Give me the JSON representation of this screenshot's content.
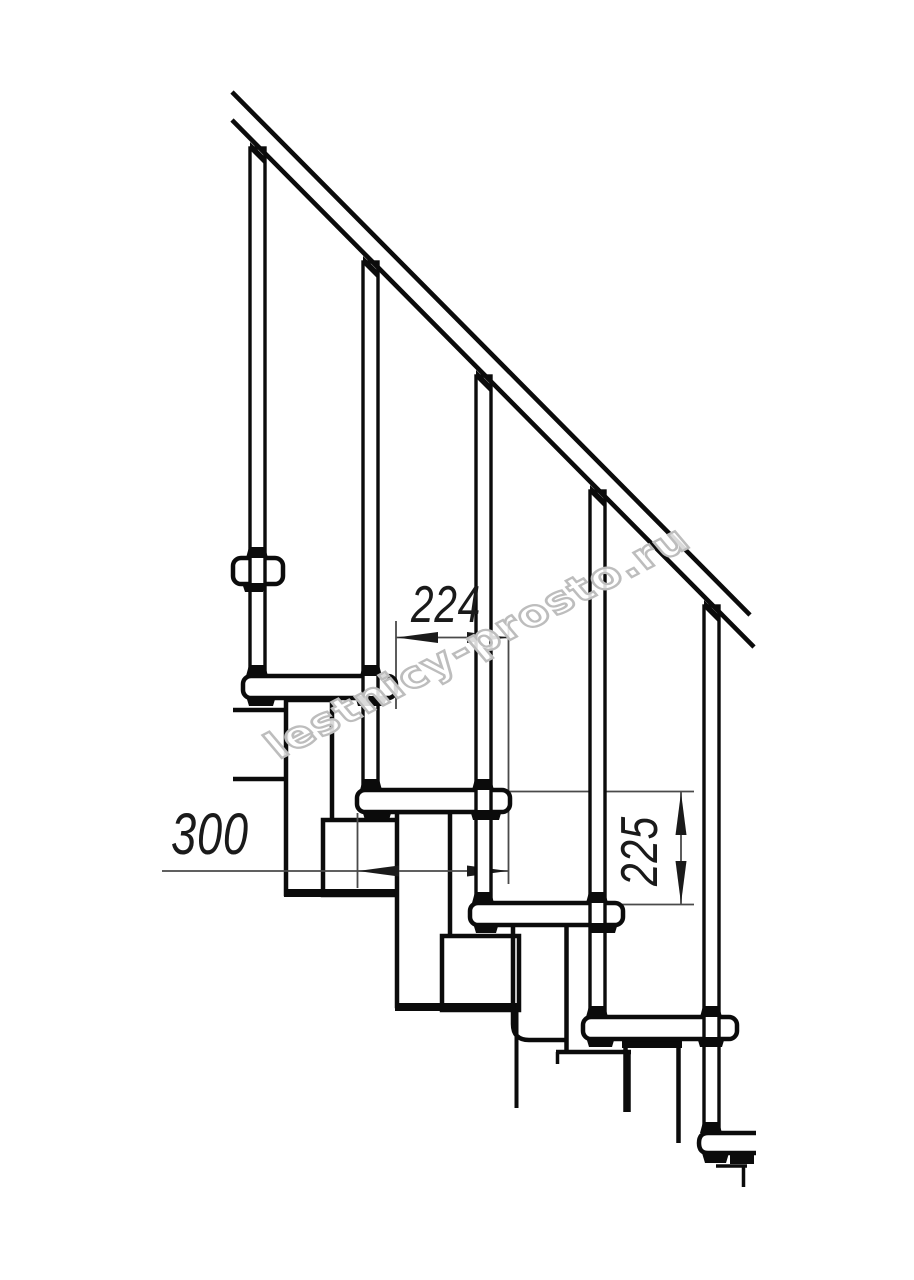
{
  "drawing": {
    "title": "modular-staircase-side-view",
    "dimensions": {
      "step_run": {
        "value": "224",
        "unit": "mm",
        "orientation": "horizontal"
      },
      "tread_depth": {
        "value": "300",
        "unit": "mm",
        "orientation": "horizontal"
      },
      "riser_height": {
        "value": "225",
        "unit": "mm",
        "orientation": "vertical"
      }
    },
    "watermark": {
      "text": "lestnicy-prosto.ru"
    },
    "elements": {
      "treads_visible": 6,
      "balusters_visible": 5,
      "handrail": "inclined-two-line"
    },
    "colors": {
      "line": "#0b0b0b",
      "dim_line": "#4a4a4a",
      "dim_text": "#1a1a1a",
      "watermark_outline": "#bdbdbd",
      "background": "#ffffff"
    }
  }
}
